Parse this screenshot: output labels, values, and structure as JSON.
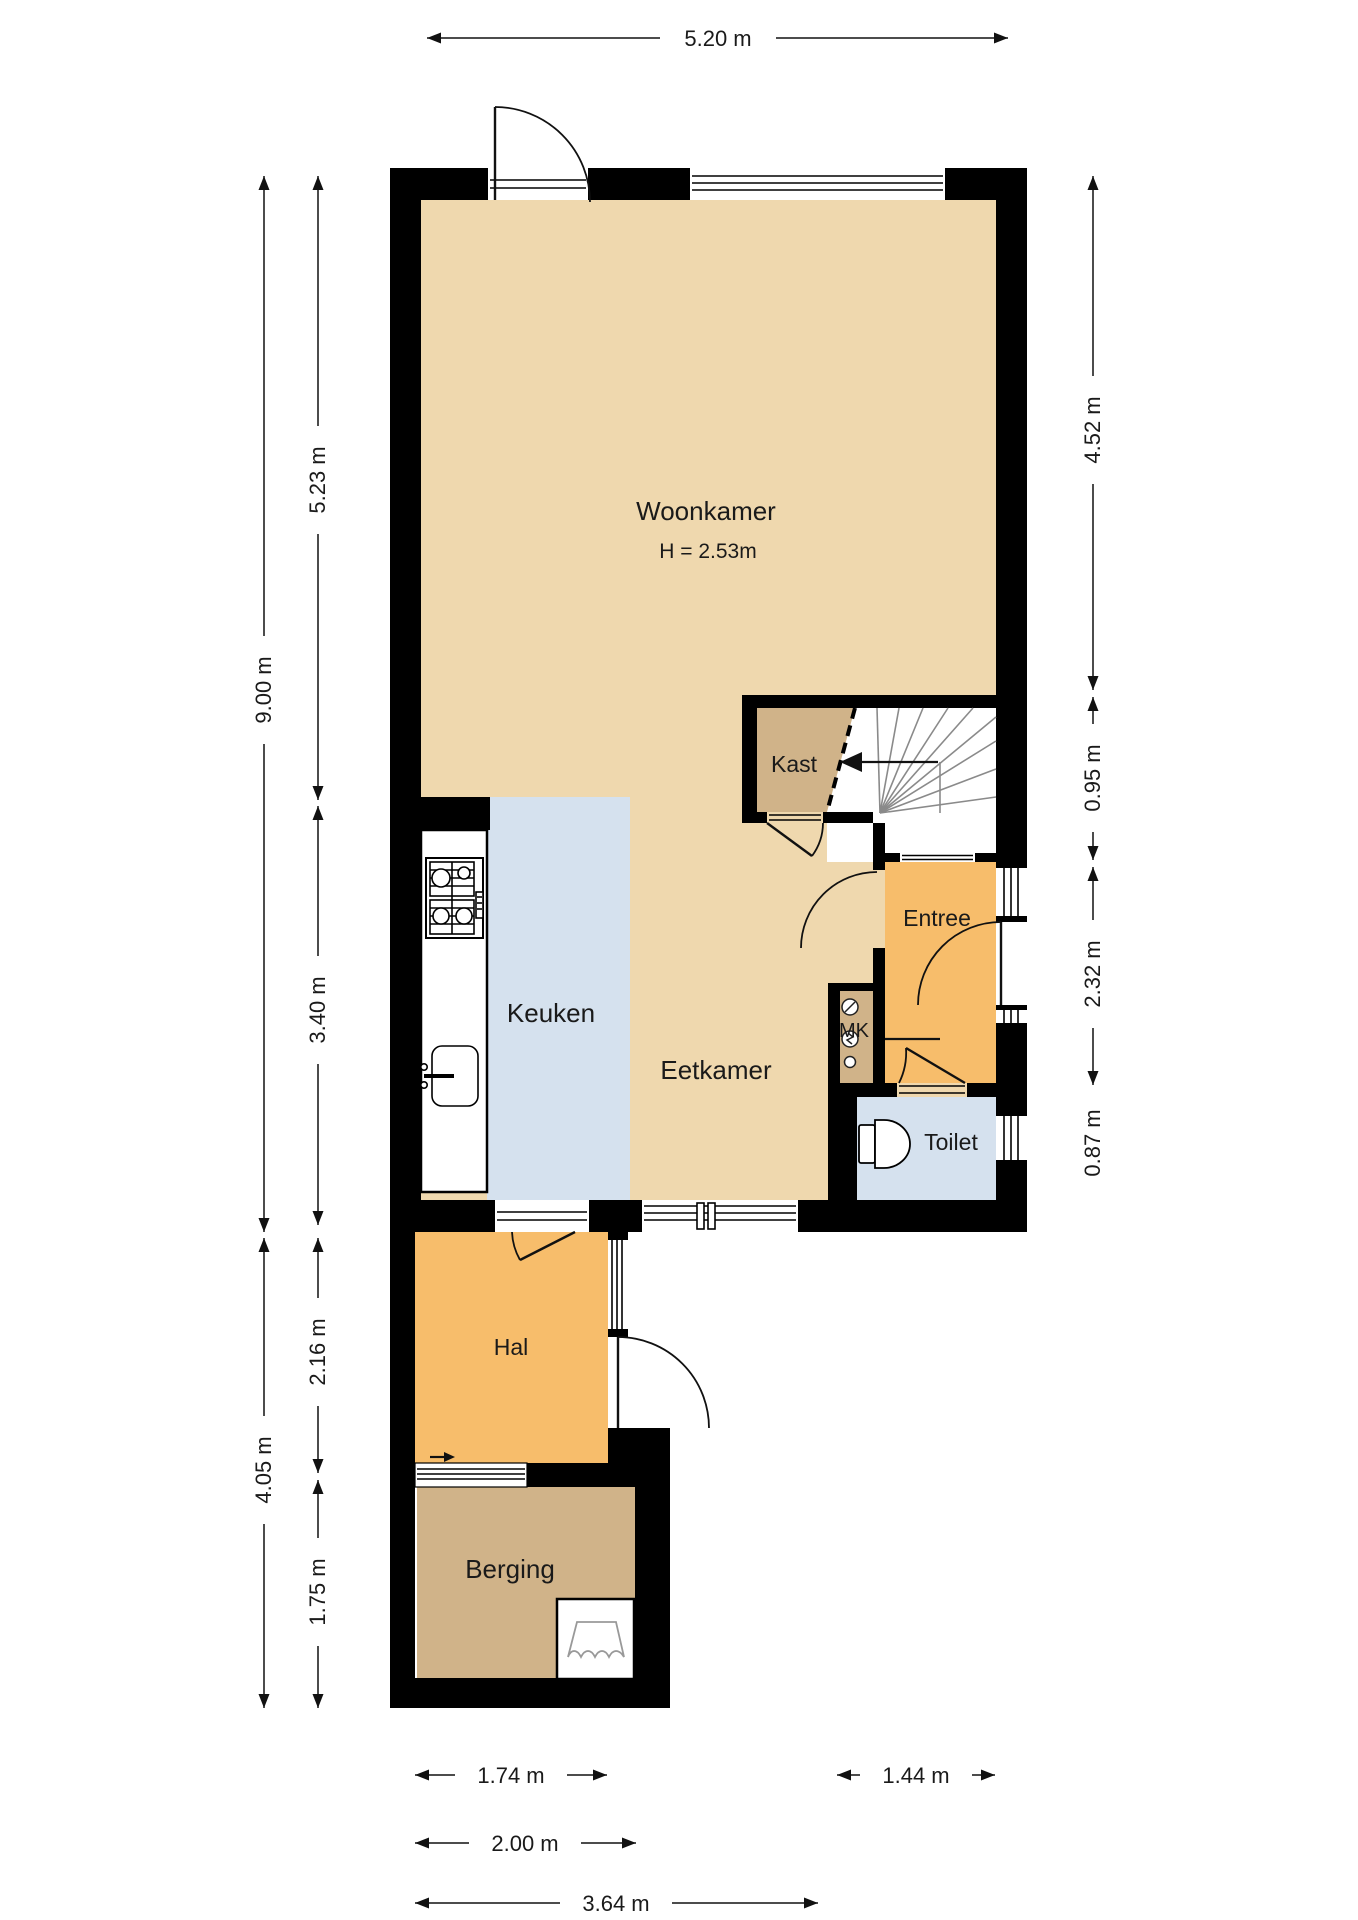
{
  "labels": {
    "woonkamer": "Woonkamer",
    "woonkamer_height": "H = 2.53m",
    "keuken": "Keuken",
    "eetkamer": "Eetkamer",
    "kast": "Kast",
    "entree": "Entree",
    "mk": "MK",
    "toilet": "Toilet",
    "hal": "Hal",
    "berging": "Berging"
  },
  "dims": {
    "top_width": "5.20 m",
    "main_height": "9.00 m",
    "woonkamer_height": "5.23 m",
    "keuken_height": "3.40 m",
    "right_upper": "4.52 m",
    "stairs_height": "0.95 m",
    "entree_height": "2.32 m",
    "toilet_height": "0.87 m",
    "lower_total_height": "4.05 m",
    "hal_height": "2.16 m",
    "berging_height": "1.75 m",
    "berging_width": "1.74 m",
    "toilet_width": "1.44 m",
    "hal_width": "2.00 m",
    "lower_width": "3.64 m"
  },
  "icons": [
    "stove-icon",
    "sink-icon",
    "toilet-bowl-icon",
    "washing-machine-icon",
    "meter-icons",
    "stair-direction-arrow",
    "entry-arrow"
  ],
  "colors": {
    "living_floor": "#EFD8AE",
    "kitchen_floor": "#D5E1EE",
    "hall_floor": "#F7BD6B",
    "storage_floor": "#D0B389",
    "wall": "#000000",
    "stair_lines": "#8A8A8A",
    "dim_lines": "#111111"
  }
}
